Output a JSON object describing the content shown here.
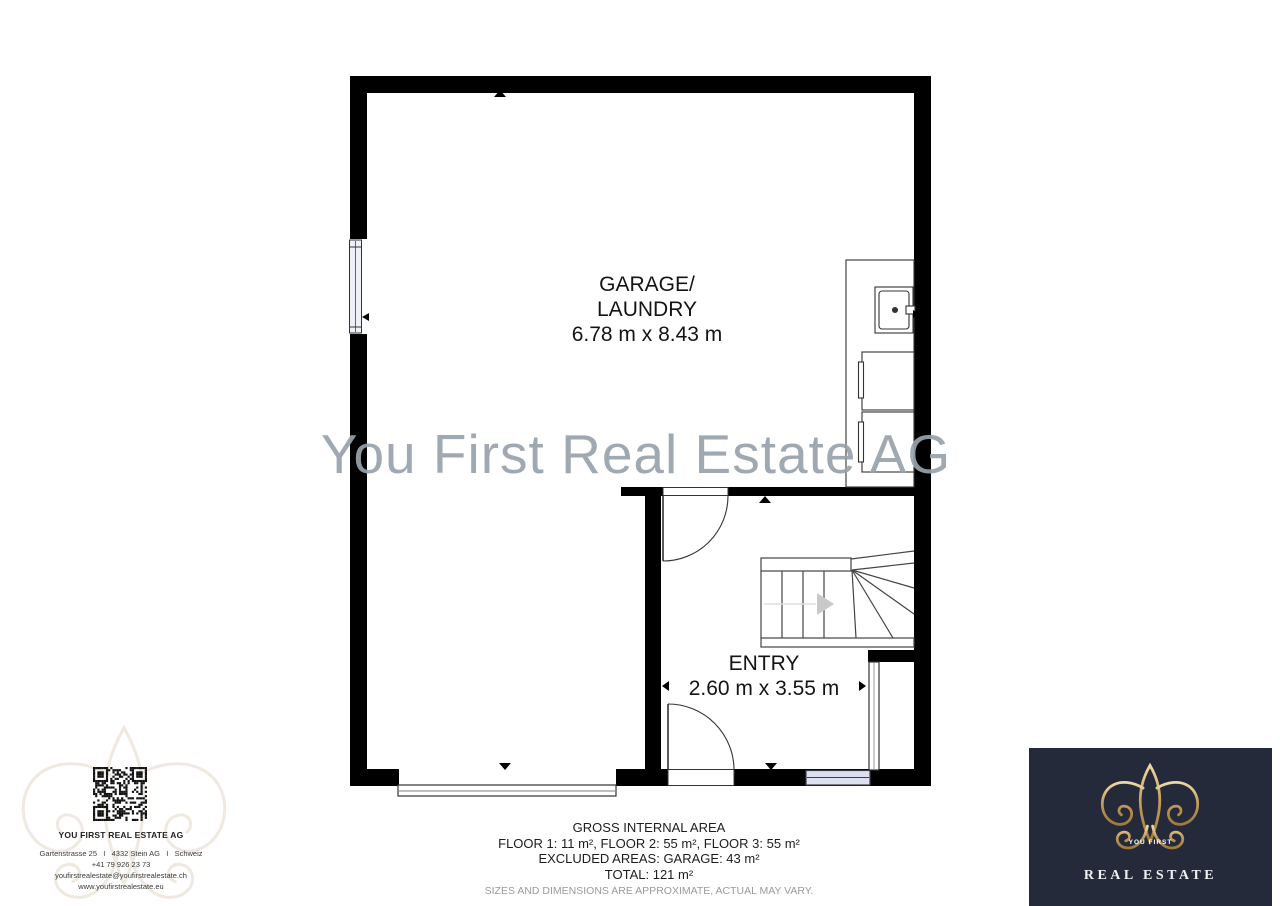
{
  "plan": {
    "watermark": "You First Real Estate AG",
    "rooms": {
      "garage": {
        "name_line1": "GARAGE/",
        "name_line2": "LAUNDRY",
        "dimensions": "6.78 m x 8.43 m"
      },
      "entry": {
        "name": "ENTRY",
        "dimensions": "2.60 m x 3.55 m"
      }
    }
  },
  "area_summary": {
    "title": "GROSS INTERNAL AREA",
    "floors": "FLOOR 1: 11 m², FLOOR 2: 55 m², FLOOR 3: 55 m²",
    "excluded": "EXCLUDED AREAS: GARAGE: 43 m²",
    "total": "TOTAL: 121 m²",
    "disclaimer": "SIZES AND DIMENSIONS ARE APPROXIMATE, ACTUAL MAY VARY."
  },
  "agency_card": {
    "name": "YOU FIRST REAL ESTATE AG",
    "address": "Gartenstrasse 25   I   4332 Stein AG   I   Schweiz",
    "phone": "+41 79 926 23 73",
    "email": "youfirstrealestate@youfirstrealestate.ch",
    "website": "www.youfirstrealestate.eu"
  },
  "brand_logo": {
    "tagline_top": "YOU FIRST",
    "tagline_bottom": "REAL ESTATE"
  },
  "colors": {
    "wall": "#000000",
    "watermark_gray": "#99a2ab",
    "window_tint": "#dde0ee",
    "logo_background": "#242a3a",
    "logo_gold": "#c49a58"
  }
}
